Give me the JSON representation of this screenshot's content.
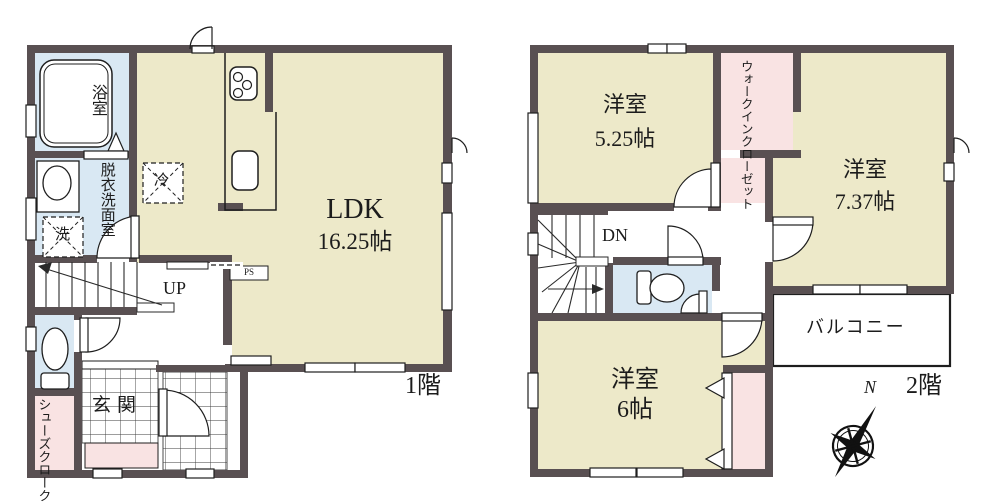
{
  "floor1": {
    "floor_label": "1階",
    "ldk": {
      "name": "LDK",
      "size": "16.25帖"
    },
    "bath": "浴室",
    "washroom": "脱衣洗面室",
    "genkan": "玄関",
    "shoe_closet": "シューズクローク",
    "stairs_direction": "UP",
    "pipe_space": "PS",
    "fridge_mark": "冷",
    "laundry_mark": "洗"
  },
  "floor2": {
    "floor_label": "2階",
    "room_525": {
      "name": "洋室",
      "size": "5.25帖"
    },
    "room_737": {
      "name": "洋室",
      "size": "7.37帖"
    },
    "room_6": {
      "name": "洋室",
      "size": "6帖"
    },
    "walk_in_closet": "ウォークインクローゼット",
    "balcony": "バルコニー",
    "stairs_direction": "DN"
  },
  "compass": {
    "north_label": "N"
  },
  "colors": {
    "room_cream": "#EDE9C9",
    "water_blue": "#D9E8F3",
    "closet_pink": "#F9E3E3",
    "wall": "#595052",
    "line": "#1e1e1e"
  }
}
